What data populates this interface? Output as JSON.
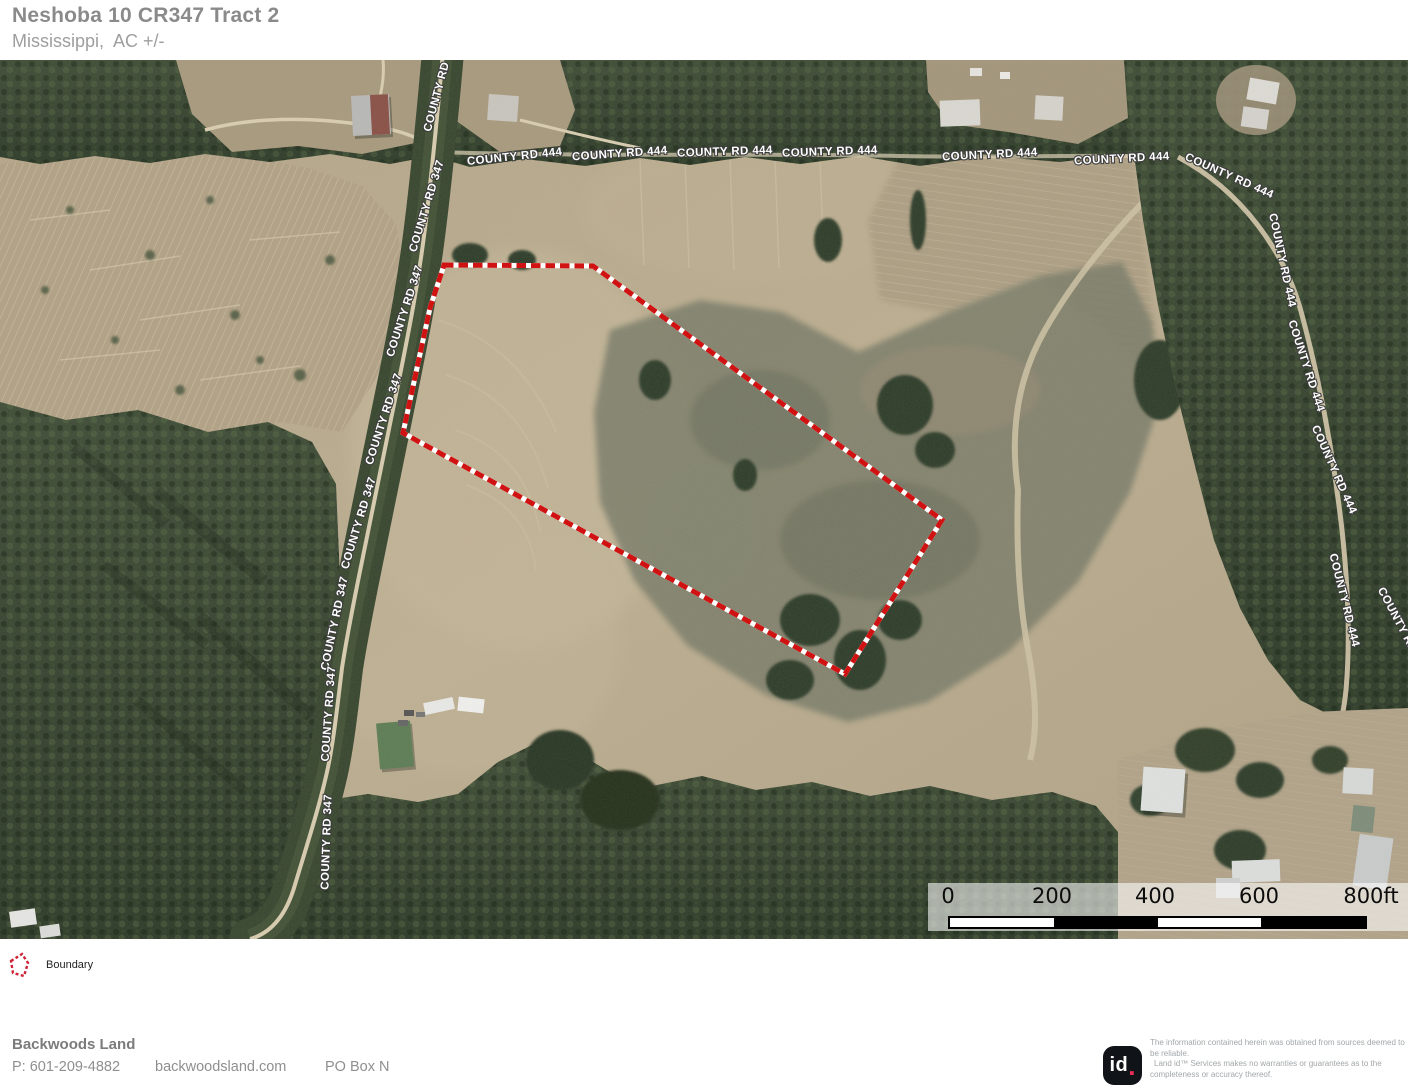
{
  "header": {
    "title": "Neshoba 10 CR347 Tract 2",
    "subtitle": "Mississippi,  AC +/-"
  },
  "map": {
    "road_label_444": "COUNTY RD 444",
    "road_label_347": "COUNTY RD 347",
    "scale_ticks": [
      "0",
      "200",
      "400",
      "600",
      "800ft"
    ],
    "colors": {
      "boundary_red": "#d01212",
      "field_tan": "#b7a98c",
      "forest_green": "#36432e"
    }
  },
  "legend": {
    "boundary_label": "Boundary"
  },
  "footer": {
    "company": "Backwoods Land",
    "phone": "P: 601-209-4882",
    "website": "backwoodsland.com",
    "po_box": "PO Box N"
  },
  "attribution": {
    "logo_id": "id",
    "logo_dot": ".",
    "disclaimer_1": "The information contained herein was obtained from sources deemed to be reliable.",
    "disclaimer_2": "Land id™ Services makes no warranties or guarantees as to the completeness or accuracy thereof."
  }
}
